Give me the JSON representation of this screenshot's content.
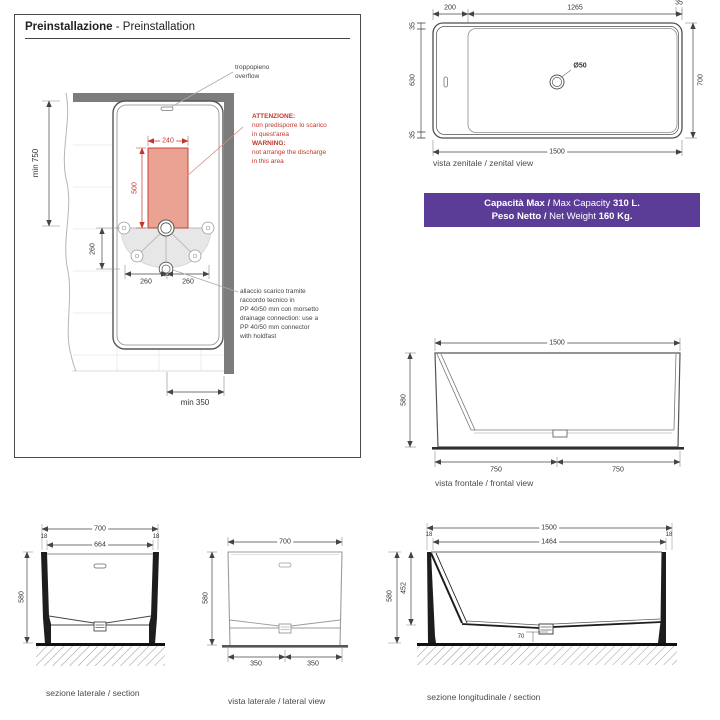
{
  "colors": {
    "banner_bg": "#5b3d97",
    "warning_red": "#c3352b",
    "restricted_zone_fill": "#eaa392",
    "wall_gray": "#7c7c7c"
  },
  "pre": {
    "title_bold": "Preinstallazione",
    "title_rest": " - Preinstallation",
    "overflow_line1": "troppopieno",
    "overflow_line2": "overflow",
    "warning": {
      "it_title": "ATTENZIONE:",
      "it_line1": "non predisporre lo scarico",
      "it_line2": "in quest'area",
      "en_title": "WARNING:",
      "en_line1": "not arrange the discharge",
      "en_line2": "in this area"
    },
    "drain_note": {
      "line1": "allaccio scarico tramite",
      "line2": "raccordo tecnico in",
      "line3": "PP 40/50 mm con morsetto",
      "line4": "drainage connection: use a",
      "line5": "PP 40/50 mm connector",
      "line6": "with holdfast"
    },
    "dims": {
      "min_front": "min 750",
      "zone_width": "240",
      "zone_height": "500",
      "drain_offset": "260",
      "feet_left": "260",
      "feet_right": "260",
      "min_side": "min 350"
    }
  },
  "zenital": {
    "caption": "vista zenitale / zenital view",
    "dims": {
      "ledge": "200",
      "basin_length": "1265",
      "rim_top_right": "35",
      "rim_top": "35",
      "basin_width": "630",
      "rim_bottom": "35",
      "width": "700",
      "length": "1500",
      "drain": "Ø50"
    }
  },
  "banner": {
    "line1": [
      {
        "text": "Capacità Max / ",
        "bold": true
      },
      {
        "text": "Max Capacity ",
        "bold": false
      },
      {
        "text": "310 L.",
        "bold": true
      }
    ],
    "line2": [
      {
        "text": "Peso Netto / ",
        "bold": true
      },
      {
        "text": "Net Weight ",
        "bold": false
      },
      {
        "text": "160 Kg.",
        "bold": true
      }
    ]
  },
  "frontal": {
    "caption": "vista frontale / frontal view",
    "dims": {
      "length": "1500",
      "height": "580",
      "left": "750",
      "right": "750"
    }
  },
  "section_lateral": {
    "caption": "sezione laterale / section",
    "dims": {
      "width": "700",
      "wall_left": "18",
      "inner": "664",
      "wall_right": "18",
      "height": "580"
    }
  },
  "lateral": {
    "caption": "vista laterale / lateral view",
    "dims": {
      "width": "700",
      "height": "580",
      "left": "350",
      "right": "350"
    }
  },
  "longitudinal": {
    "caption": "sezione longitudinale / section",
    "dims": {
      "length": "1500",
      "wall_left": "18",
      "inner": "1464",
      "wall_right": "18",
      "height": "580",
      "depth": "452",
      "drain_height": "70"
    }
  }
}
